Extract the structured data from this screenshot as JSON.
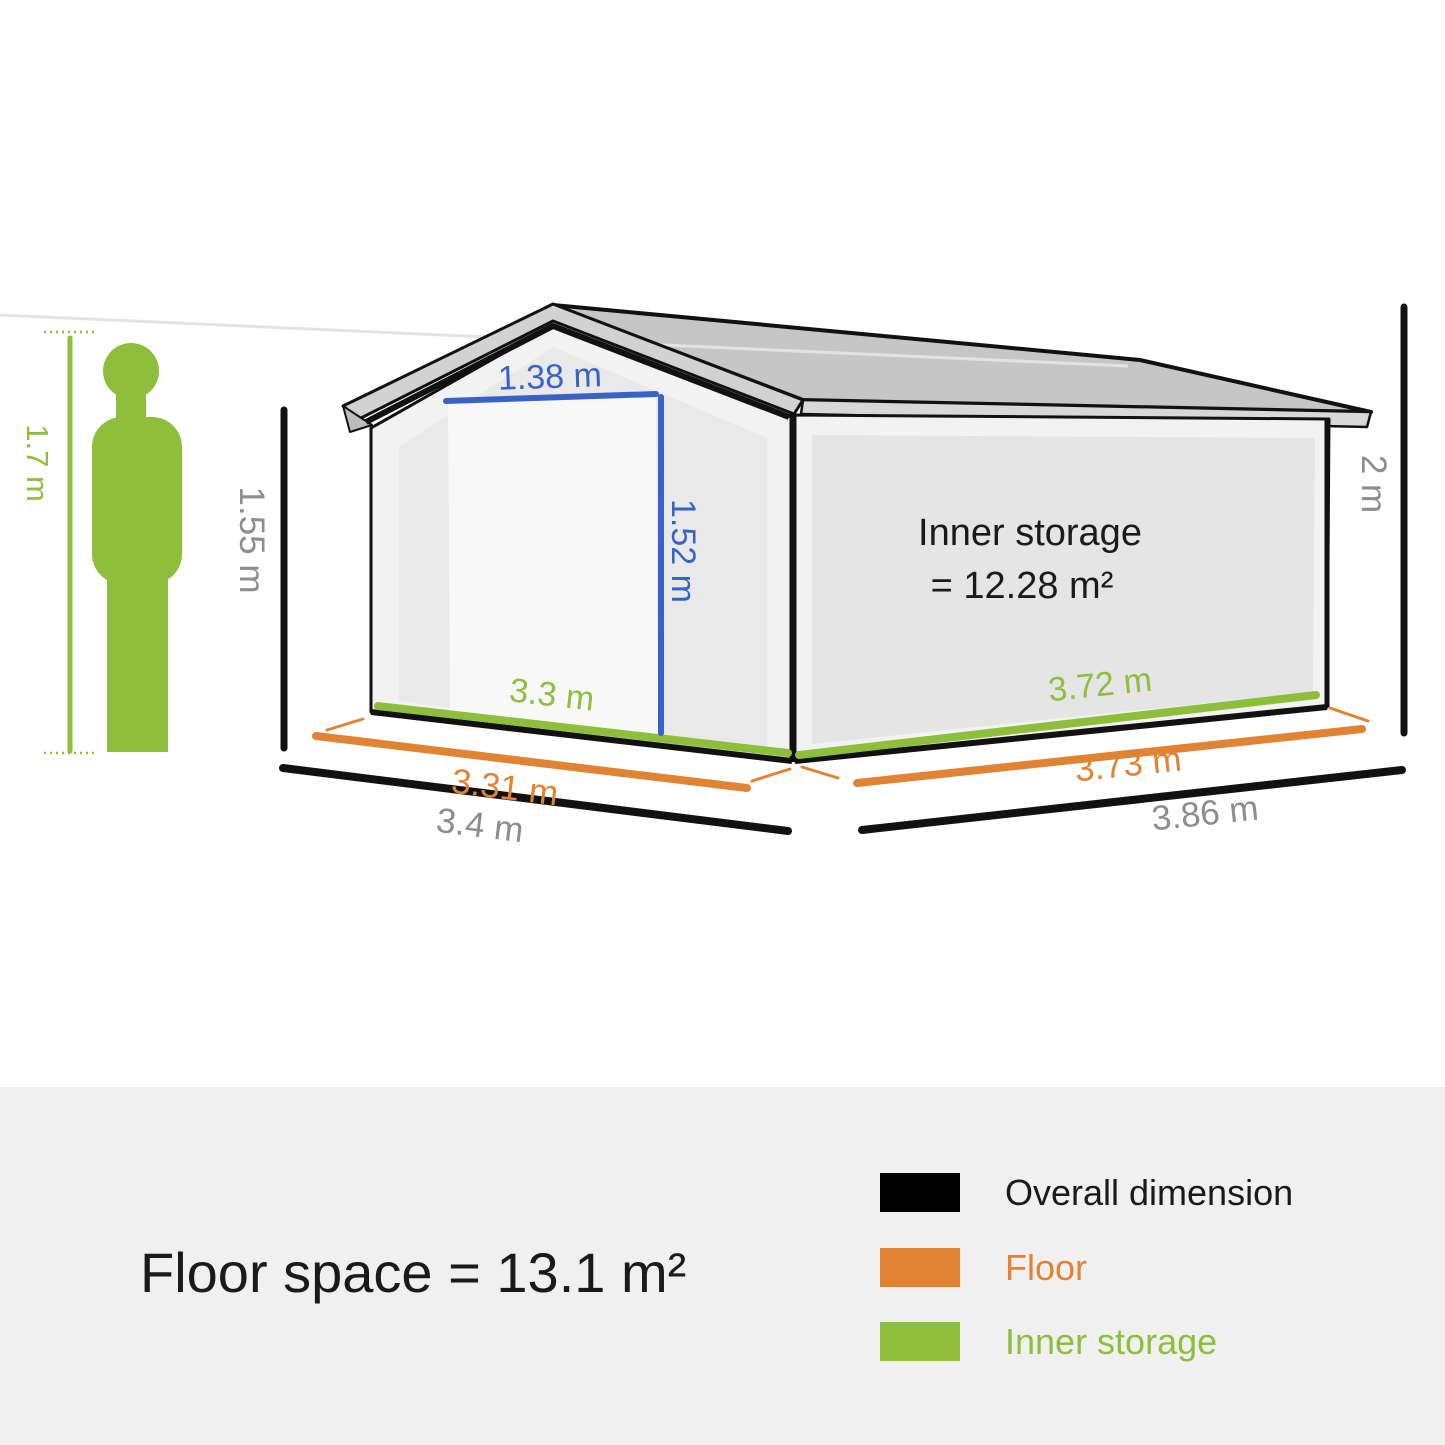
{
  "palette": {
    "green": "#8fbe3d",
    "orange": "#e08434",
    "blue": "#3a62c4",
    "gray_text": "#8d8d8d",
    "black": "#111111",
    "roof": "#c6c6c6",
    "fascia": "#d8d8d8",
    "wall": "#f2f2f2",
    "footer_bg": "#f0f0f0"
  },
  "person": {
    "height_label": "1.7 m"
  },
  "dimensions": {
    "door_width": "1.38 m",
    "door_height": "1.52 m",
    "wall_height": "1.55 m",
    "total_height": "2 m",
    "inner_width": "3.3 m",
    "inner_depth": "3.72 m",
    "floor_width": "3.31 m",
    "floor_depth": "3.73 m",
    "overall_width": "3.4 m",
    "overall_depth": "3.86 m"
  },
  "inner_storage": {
    "line1": "Inner storage",
    "line2": "= 12.28 m²"
  },
  "footer": {
    "floor_space": "Floor space = 13.1 m²",
    "legend": [
      {
        "label": "Overall dimension",
        "swatch": "#000000",
        "text_color": "#1a1a1a"
      },
      {
        "label": "Floor",
        "swatch": "#e08434",
        "text_color": "#e08434"
      },
      {
        "label": "Inner storage",
        "swatch": "#8fbe3d",
        "text_color": "#8fbe3d"
      }
    ]
  }
}
